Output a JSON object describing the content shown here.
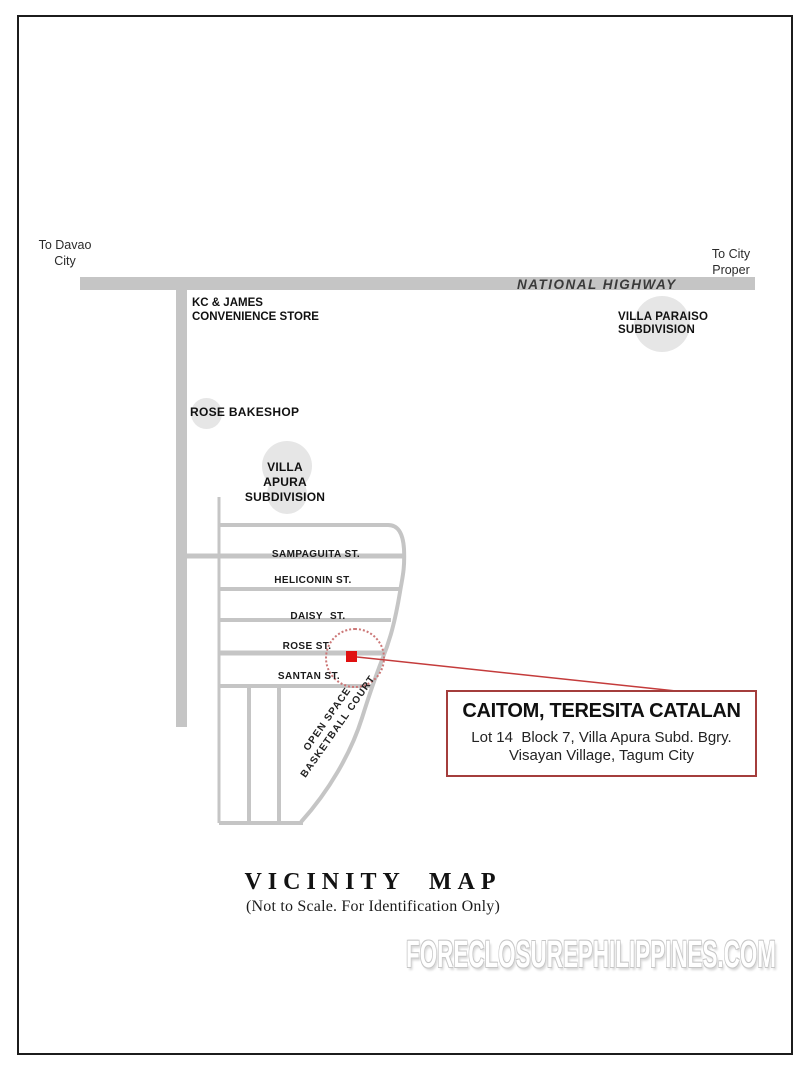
{
  "map": {
    "direction_left_line1": "To Davao",
    "direction_left_line2": "City",
    "direction_right_line1": "To City",
    "direction_right_line2": "Proper",
    "highway_label": "NATIONAL HIGHWAY",
    "store_line1": "KC & JAMES",
    "store_line2": "CONVENIENCE STORE",
    "bakeshop_label": "ROSE BAKESHOP",
    "villa_apura_line1": "VILLA APURA",
    "villa_apura_line2": "SUBDIVISION",
    "villa_paraiso_line1": "VILLA PARAISO",
    "villa_paraiso_line2": "SUBDIVISION",
    "streets": [
      "SAMPAGUITA ST.",
      "HELICONIN ST.",
      "DAISY ST.",
      "ROSE ST.",
      "SANTAN ST."
    ],
    "open_space_line1": "OPEN SPACE",
    "open_space_line2": "BASKETBALL COURT"
  },
  "callout": {
    "owner_name": "CAITOM, TERESITA CATALAN",
    "address_line1": "Lot 14  Block 7, Villa Apura Subd. Bgry.",
    "address_line2": "Visayan Village, Tagum City"
  },
  "footer": {
    "title": "VICINITY MAP",
    "subtitle": "(Not to Scale. For Identification Only)",
    "watermark": "FORECLOSUREPHILIPPINES.COM"
  },
  "colors": {
    "road_gray": "#c5c5c5",
    "halo_gray": "#e6e6e6",
    "leader_red": "#c43b3b",
    "marker_red": "#e01010",
    "callout_border_red": "#a43d3c"
  }
}
